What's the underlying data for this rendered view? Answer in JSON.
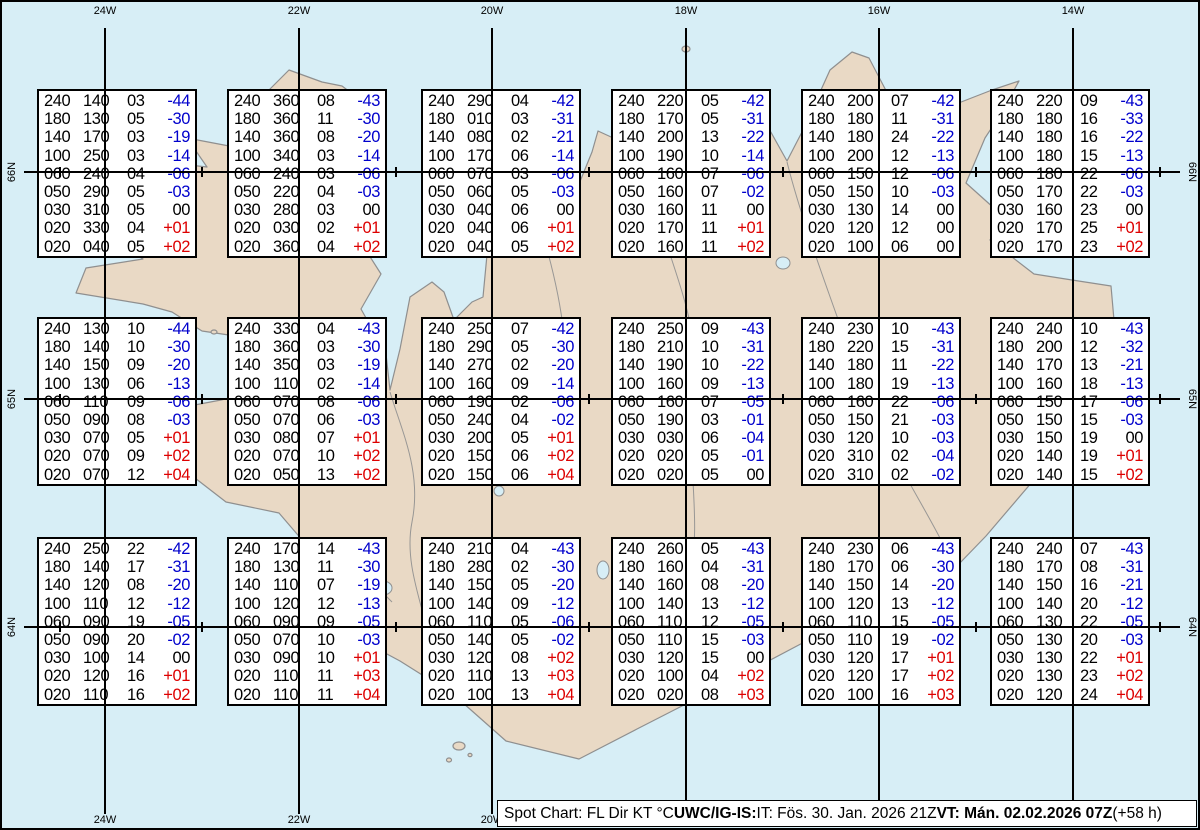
{
  "map": {
    "lon_labels": [
      "24W",
      "22W",
      "20W",
      "18W",
      "16W",
      "14W"
    ],
    "lat_labels": [
      "66N",
      "65N",
      "64N"
    ],
    "colors": {
      "sea": "#d7eef6",
      "land": "#e9d9c5",
      "coast": "#8f8f8f",
      "grid": "#000000",
      "temp_negative": "#0000cc",
      "temp_positive": "#dd0000",
      "temp_zero": "#000000"
    }
  },
  "legend": "FL Dir KT °C",
  "boxes": [
    {
      "rows": [
        [
          "240",
          "140",
          "03",
          "-44"
        ],
        [
          "180",
          "130",
          "05",
          "-30"
        ],
        [
          "140",
          "170",
          "03",
          "-19"
        ],
        [
          "100",
          "250",
          "03",
          "-14"
        ],
        [
          "060",
          "240",
          "04",
          "-06"
        ],
        [
          "050",
          "290",
          "05",
          "-03"
        ],
        [
          "030",
          "310",
          "05",
          "00"
        ],
        [
          "020",
          "330",
          "04",
          "+01"
        ],
        [
          "020",
          "040",
          "05",
          "+02"
        ]
      ]
    },
    {
      "rows": [
        [
          "240",
          "360",
          "08",
          "-43"
        ],
        [
          "180",
          "360",
          "11",
          "-30"
        ],
        [
          "140",
          "360",
          "08",
          "-20"
        ],
        [
          "100",
          "340",
          "03",
          "-14"
        ],
        [
          "060",
          "240",
          "03",
          "-06"
        ],
        [
          "050",
          "220",
          "04",
          "-03"
        ],
        [
          "030",
          "280",
          "03",
          "00"
        ],
        [
          "020",
          "030",
          "02",
          "+01"
        ],
        [
          "020",
          "360",
          "04",
          "+02"
        ]
      ]
    },
    {
      "rows": [
        [
          "240",
          "290",
          "04",
          "-42"
        ],
        [
          "180",
          "010",
          "03",
          "-31"
        ],
        [
          "140",
          "080",
          "02",
          "-21"
        ],
        [
          "100",
          "170",
          "06",
          "-14"
        ],
        [
          "060",
          "070",
          "03",
          "-06"
        ],
        [
          "050",
          "060",
          "05",
          "-03"
        ],
        [
          "030",
          "040",
          "06",
          "00"
        ],
        [
          "020",
          "040",
          "06",
          "+01"
        ],
        [
          "020",
          "040",
          "05",
          "+02"
        ]
      ]
    },
    {
      "rows": [
        [
          "240",
          "220",
          "05",
          "-42"
        ],
        [
          "180",
          "170",
          "05",
          "-31"
        ],
        [
          "140",
          "200",
          "13",
          "-22"
        ],
        [
          "100",
          "190",
          "10",
          "-14"
        ],
        [
          "060",
          "160",
          "07",
          "-06"
        ],
        [
          "050",
          "160",
          "07",
          "-02"
        ],
        [
          "030",
          "160",
          "11",
          "00"
        ],
        [
          "020",
          "170",
          "11",
          "+01"
        ],
        [
          "020",
          "160",
          "11",
          "+02"
        ]
      ]
    },
    {
      "rows": [
        [
          "240",
          "200",
          "07",
          "-42"
        ],
        [
          "180",
          "180",
          "11",
          "-31"
        ],
        [
          "140",
          "180",
          "24",
          "-22"
        ],
        [
          "100",
          "200",
          "12",
          "-13"
        ],
        [
          "060",
          "150",
          "12",
          "-06"
        ],
        [
          "050",
          "150",
          "10",
          "-03"
        ],
        [
          "030",
          "130",
          "14",
          "00"
        ],
        [
          "020",
          "120",
          "12",
          "00"
        ],
        [
          "020",
          "100",
          "06",
          "00"
        ]
      ]
    },
    {
      "rows": [
        [
          "240",
          "220",
          "09",
          "-43"
        ],
        [
          "180",
          "180",
          "16",
          "-33"
        ],
        [
          "140",
          "180",
          "16",
          "-22"
        ],
        [
          "100",
          "180",
          "15",
          "-13"
        ],
        [
          "060",
          "180",
          "22",
          "-06"
        ],
        [
          "050",
          "170",
          "22",
          "-03"
        ],
        [
          "030",
          "160",
          "23",
          "00"
        ],
        [
          "020",
          "170",
          "25",
          "+01"
        ],
        [
          "020",
          "170",
          "23",
          "+02"
        ]
      ]
    },
    {
      "rows": [
        [
          "240",
          "130",
          "10",
          "-44"
        ],
        [
          "180",
          "140",
          "10",
          "-30"
        ],
        [
          "140",
          "150",
          "09",
          "-20"
        ],
        [
          "100",
          "130",
          "06",
          "-13"
        ],
        [
          "060",
          "110",
          "09",
          "-06"
        ],
        [
          "050",
          "090",
          "08",
          "-03"
        ],
        [
          "030",
          "070",
          "05",
          "+01"
        ],
        [
          "020",
          "070",
          "09",
          "+02"
        ],
        [
          "020",
          "070",
          "12",
          "+04"
        ]
      ]
    },
    {
      "rows": [
        [
          "240",
          "330",
          "04",
          "-43"
        ],
        [
          "180",
          "360",
          "03",
          "-30"
        ],
        [
          "140",
          "350",
          "03",
          "-19"
        ],
        [
          "100",
          "110",
          "02",
          "-14"
        ],
        [
          "060",
          "070",
          "08",
          "-06"
        ],
        [
          "050",
          "070",
          "06",
          "-03"
        ],
        [
          "030",
          "080",
          "07",
          "+01"
        ],
        [
          "020",
          "070",
          "10",
          "+02"
        ],
        [
          "020",
          "050",
          "13",
          "+02"
        ]
      ]
    },
    {
      "rows": [
        [
          "240",
          "250",
          "07",
          "-42"
        ],
        [
          "180",
          "290",
          "05",
          "-30"
        ],
        [
          "140",
          "270",
          "02",
          "-20"
        ],
        [
          "100",
          "160",
          "09",
          "-14"
        ],
        [
          "060",
          "190",
          "02",
          "-06"
        ],
        [
          "050",
          "240",
          "04",
          "-02"
        ],
        [
          "030",
          "200",
          "05",
          "+01"
        ],
        [
          "020",
          "150",
          "06",
          "+02"
        ],
        [
          "020",
          "150",
          "06",
          "+04"
        ]
      ]
    },
    {
      "rows": [
        [
          "240",
          "250",
          "09",
          "-43"
        ],
        [
          "180",
          "210",
          "10",
          "-31"
        ],
        [
          "140",
          "190",
          "10",
          "-22"
        ],
        [
          "100",
          "160",
          "09",
          "-13"
        ],
        [
          "060",
          "160",
          "07",
          "-05"
        ],
        [
          "050",
          "190",
          "03",
          "-01"
        ],
        [
          "030",
          "030",
          "06",
          "-04"
        ],
        [
          "020",
          "020",
          "05",
          "-01"
        ],
        [
          "020",
          "020",
          "05",
          "00"
        ]
      ]
    },
    {
      "rows": [
        [
          "240",
          "230",
          "10",
          "-43"
        ],
        [
          "180",
          "220",
          "15",
          "-31"
        ],
        [
          "140",
          "180",
          "11",
          "-22"
        ],
        [
          "100",
          "180",
          "19",
          "-13"
        ],
        [
          "060",
          "160",
          "22",
          "-06"
        ],
        [
          "050",
          "150",
          "21",
          "-03"
        ],
        [
          "030",
          "120",
          "10",
          "-03"
        ],
        [
          "020",
          "310",
          "02",
          "-04"
        ],
        [
          "020",
          "310",
          "02",
          "-02"
        ]
      ]
    },
    {
      "rows": [
        [
          "240",
          "240",
          "10",
          "-43"
        ],
        [
          "180",
          "200",
          "12",
          "-32"
        ],
        [
          "140",
          "170",
          "13",
          "-21"
        ],
        [
          "100",
          "160",
          "18",
          "-13"
        ],
        [
          "060",
          "150",
          "17",
          "-06"
        ],
        [
          "050",
          "150",
          "15",
          "-03"
        ],
        [
          "030",
          "150",
          "19",
          "00"
        ],
        [
          "020",
          "140",
          "19",
          "+01"
        ],
        [
          "020",
          "140",
          "15",
          "+02"
        ]
      ]
    },
    {
      "rows": [
        [
          "240",
          "250",
          "22",
          "-42"
        ],
        [
          "180",
          "140",
          "17",
          "-31"
        ],
        [
          "140",
          "120",
          "08",
          "-20"
        ],
        [
          "100",
          "110",
          "12",
          "-12"
        ],
        [
          "060",
          "090",
          "19",
          "-05"
        ],
        [
          "050",
          "090",
          "20",
          "-02"
        ],
        [
          "030",
          "100",
          "14",
          "00"
        ],
        [
          "020",
          "120",
          "16",
          "+01"
        ],
        [
          "020",
          "110",
          "16",
          "+02"
        ]
      ]
    },
    {
      "rows": [
        [
          "240",
          "170",
          "14",
          "-43"
        ],
        [
          "180",
          "130",
          "11",
          "-30"
        ],
        [
          "140",
          "110",
          "07",
          "-19"
        ],
        [
          "100",
          "120",
          "12",
          "-13"
        ],
        [
          "060",
          "090",
          "09",
          "-05"
        ],
        [
          "050",
          "070",
          "10",
          "-03"
        ],
        [
          "030",
          "090",
          "10",
          "+01"
        ],
        [
          "020",
          "110",
          "11",
          "+03"
        ],
        [
          "020",
          "110",
          "11",
          "+04"
        ]
      ]
    },
    {
      "rows": [
        [
          "240",
          "210",
          "04",
          "-43"
        ],
        [
          "180",
          "280",
          "02",
          "-30"
        ],
        [
          "140",
          "150",
          "05",
          "-20"
        ],
        [
          "100",
          "140",
          "09",
          "-12"
        ],
        [
          "060",
          "110",
          "05",
          "-06"
        ],
        [
          "050",
          "140",
          "05",
          "-02"
        ],
        [
          "030",
          "120",
          "08",
          "+02"
        ],
        [
          "020",
          "110",
          "13",
          "+03"
        ],
        [
          "020",
          "100",
          "13",
          "+04"
        ]
      ]
    },
    {
      "rows": [
        [
          "240",
          "260",
          "05",
          "-43"
        ],
        [
          "180",
          "160",
          "04",
          "-31"
        ],
        [
          "140",
          "160",
          "08",
          "-20"
        ],
        [
          "100",
          "140",
          "13",
          "-12"
        ],
        [
          "060",
          "110",
          "12",
          "-05"
        ],
        [
          "050",
          "110",
          "15",
          "-03"
        ],
        [
          "030",
          "120",
          "15",
          "00"
        ],
        [
          "020",
          "100",
          "04",
          "+02"
        ],
        [
          "020",
          "020",
          "08",
          "+03"
        ]
      ]
    },
    {
      "rows": [
        [
          "240",
          "230",
          "06",
          "-43"
        ],
        [
          "180",
          "170",
          "06",
          "-30"
        ],
        [
          "140",
          "150",
          "14",
          "-20"
        ],
        [
          "100",
          "120",
          "13",
          "-12"
        ],
        [
          "060",
          "110",
          "15",
          "-05"
        ],
        [
          "050",
          "110",
          "19",
          "-02"
        ],
        [
          "030",
          "120",
          "17",
          "+01"
        ],
        [
          "020",
          "120",
          "17",
          "+02"
        ],
        [
          "020",
          "100",
          "16",
          "+03"
        ]
      ]
    },
    {
      "rows": [
        [
          "240",
          "240",
          "07",
          "-43"
        ],
        [
          "180",
          "170",
          "08",
          "-31"
        ],
        [
          "140",
          "150",
          "16",
          "-21"
        ],
        [
          "100",
          "140",
          "20",
          "-12"
        ],
        [
          "060",
          "130",
          "22",
          "-05"
        ],
        [
          "050",
          "130",
          "20",
          "-03"
        ],
        [
          "030",
          "130",
          "22",
          "+01"
        ],
        [
          "020",
          "130",
          "23",
          "+02"
        ],
        [
          "020",
          "120",
          "24",
          "+04"
        ]
      ]
    }
  ],
  "caption": {
    "prefix": "Spot Chart: FL Dir KT °C ",
    "issuer_bold": "UWC/IG-IS:",
    "issue_info": " IT: Fös. 30. Jan. 2026 21Z ",
    "valid_bold": "VT: Mán. 02.02.2026 07Z",
    "suffix": " (+58 h)"
  }
}
